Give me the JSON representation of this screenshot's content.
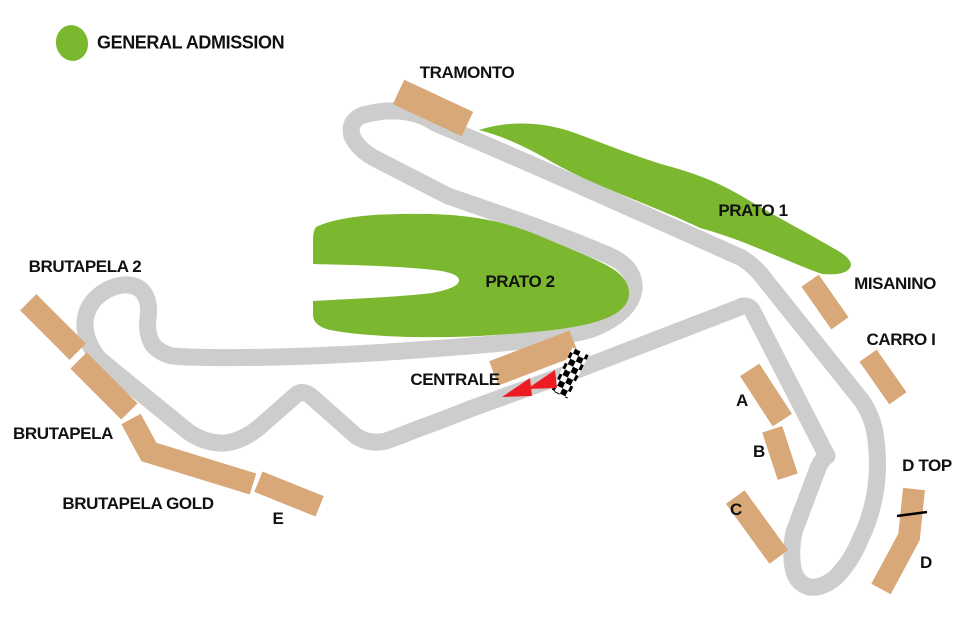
{
  "legend": {
    "label": "GENERAL ADMISSION"
  },
  "colors": {
    "general_admission_green": "#7cb82f",
    "grandstand_tan": "#d8a878",
    "track_gray": "#cdcdcd",
    "direction_arrow_red": "#ed1c24",
    "label_text": "#111111"
  },
  "areas": {
    "prato1": "PRATO 1",
    "prato2": "PRATO 2"
  },
  "grandstands": {
    "tramonto": "TRAMONTO",
    "brutapela2": "BRUTAPELA 2",
    "brutapela": "BRUTAPELA",
    "brutapela_gold": "BRUTAPELA GOLD",
    "e": "E",
    "centrale": "CENTRALE",
    "misanino": "MISANINO",
    "carro": "CARRO I",
    "a": "A",
    "b": "B",
    "c": "C",
    "d_top": "D TOP",
    "d": "D"
  },
  "icons": {
    "start_finish": "checkered-flag-strip",
    "race_direction": "red-left-arrows"
  }
}
